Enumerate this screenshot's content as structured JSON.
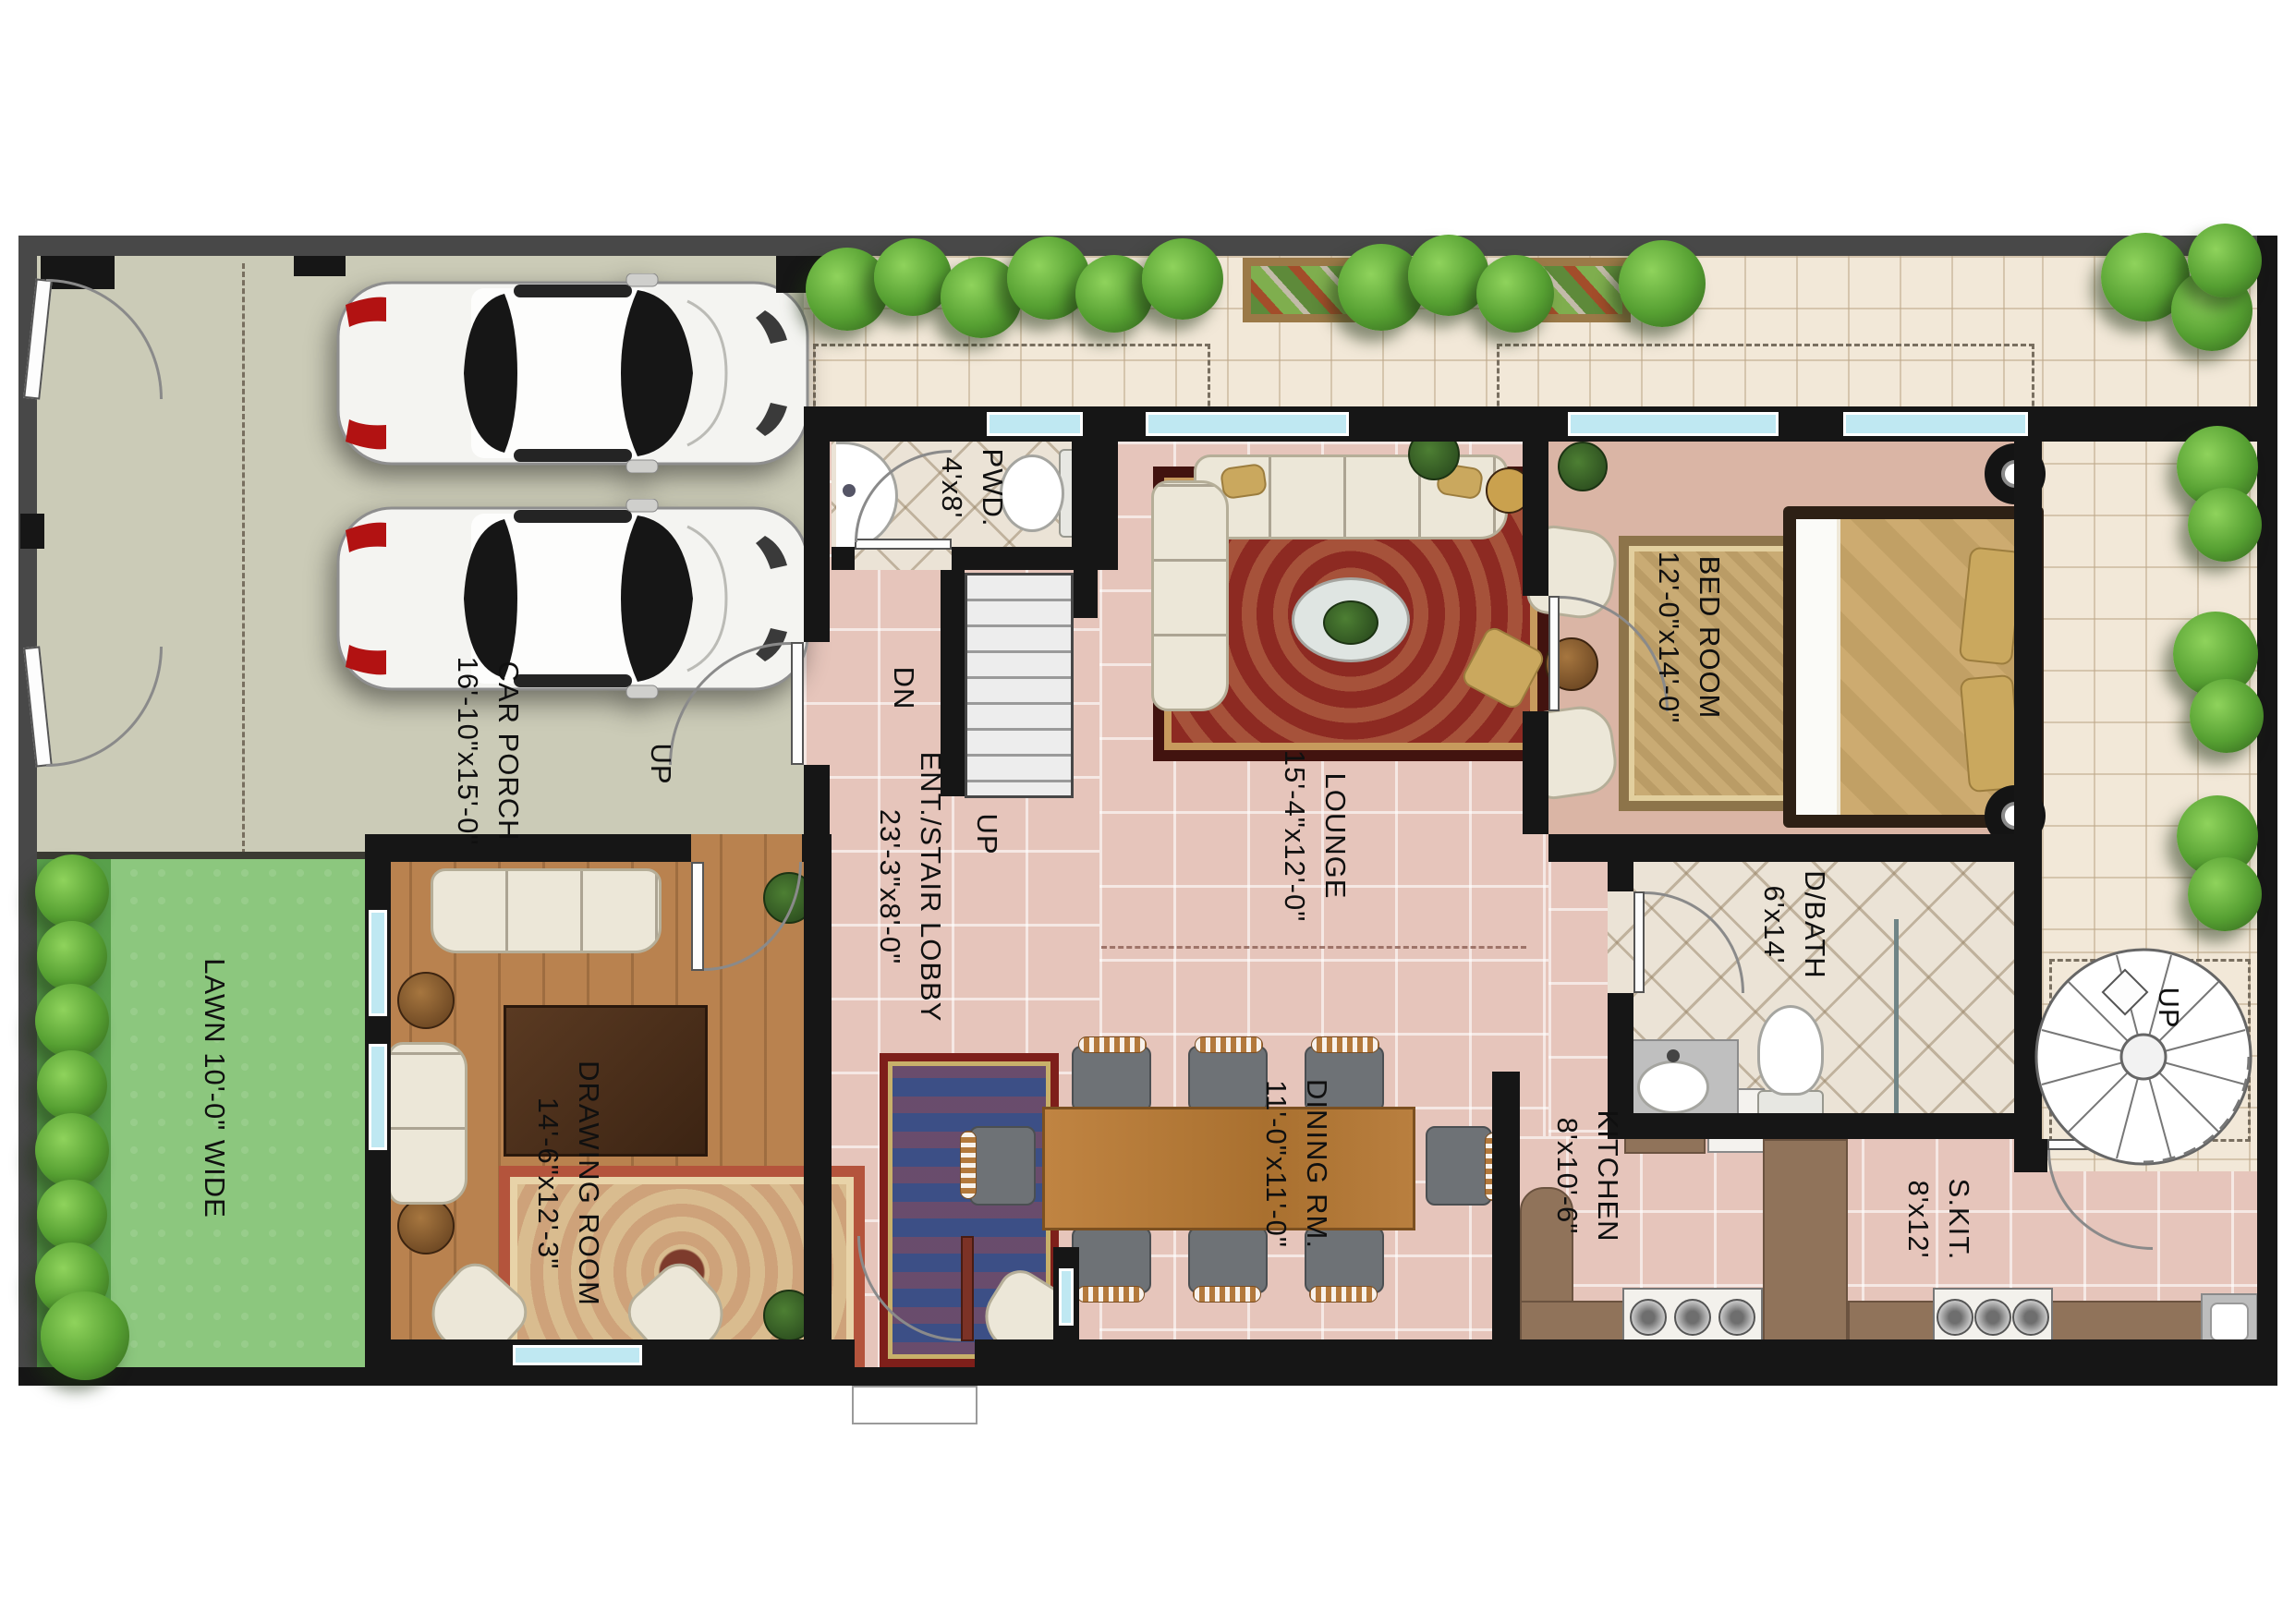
{
  "rooms": {
    "car_porch": {
      "name": "CAR PORCH",
      "dims": "16'-10\"x15'-0\""
    },
    "lawn": {
      "name": "LAWN 10'-0\" WIDE"
    },
    "drawing_room": {
      "name": "DRAWING ROOM",
      "dims": "14'-6\"x12'-3\""
    },
    "powder": {
      "name": "PWD.",
      "dims": "4'x8'"
    },
    "lobby": {
      "name": "ENT./STAIR LOBBY",
      "dims": "23'-3\"x8'-0\""
    },
    "lounge": {
      "name": "LOUNGE",
      "dims": "15'-4\"x12'-0\""
    },
    "bedroom": {
      "name": "BED ROOM",
      "dims": "12'-0\"x14'-0\""
    },
    "bath": {
      "name": "D/BATH",
      "dims": "6'x14'"
    },
    "dining": {
      "name": "DINING RM.",
      "dims": "11'-0\"x11'-0\""
    },
    "kitchen": {
      "name": "KITCHEN",
      "dims": "8'x10'-6\""
    },
    "spice_kitchen": {
      "name": "S.KIT.",
      "dims": "8'x12'"
    }
  },
  "stairs": {
    "porch_up": "UP",
    "lobby_up": "UP",
    "stair_dn": "DN",
    "spiral_up": "UP"
  },
  "colors": {
    "wall": "#161616",
    "boundary": "#484848",
    "porch_floor": "#cbcbb7",
    "patio_floor": "#f2e8d8",
    "pink_floor": "#e6c5bb",
    "bedroom_floor": "#dab5a5",
    "bath_floor": "#ebe3d6",
    "wood_floor": "#b9824f",
    "lawn": "#8cc77e",
    "window_glass": "#bfe8f2",
    "shrub": "#56a032"
  }
}
